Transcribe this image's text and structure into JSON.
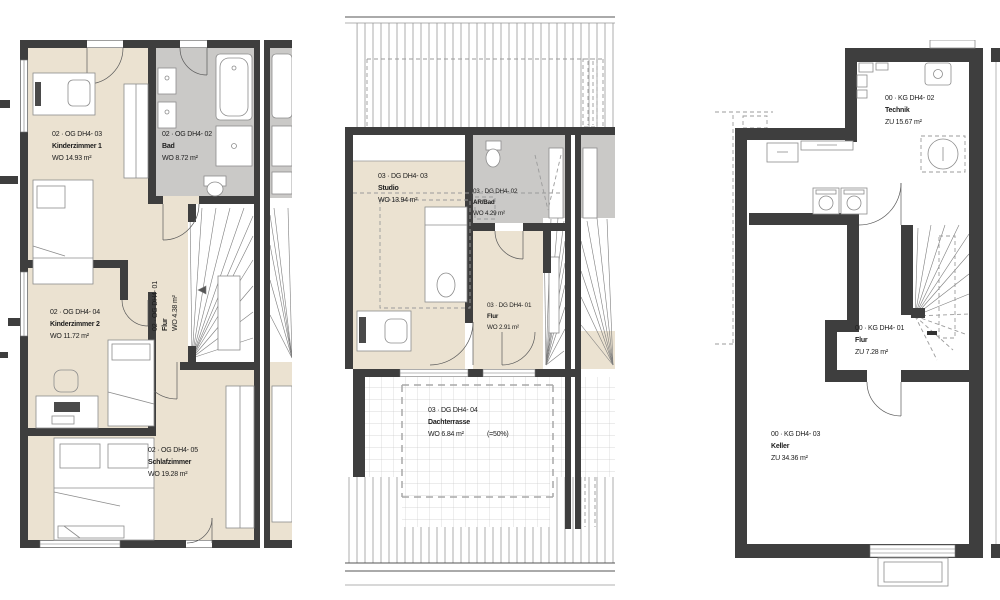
{
  "document": {
    "type": "floor-plan-sheet",
    "units": "m²"
  },
  "colors": {
    "wall": "#3e3e3e",
    "room_beige": "#ebe2d1",
    "bath_gray": "#cac9c7",
    "furniture_line": "#8c8c8c",
    "dashed_gray": "#9b9b9b"
  },
  "plans": {
    "og": {
      "level": "02 OG",
      "rooms": {
        "kinderzimmer1": {
          "code": "02 · OG DH4- 03",
          "name": "Kinderzimmer 1",
          "area": "WO 14.93 m²"
        },
        "bad": {
          "code": "02 · OG DH4- 02",
          "name": "Bad",
          "area": "WO 8.72 m²"
        },
        "flur": {
          "code": "02 · OG DH4- 01",
          "name": "Flur",
          "area": "WO 4.38 m²"
        },
        "kinderzimmer2": {
          "code": "02 · OG DH4- 04",
          "name": "Kinderzimmer 2",
          "area": "WO 11.72 m²"
        },
        "schlafzimmer": {
          "code": "02 · OG DH4- 05",
          "name": "Schlafzimmer",
          "area": "WO 19.28 m²"
        }
      }
    },
    "dg": {
      "level": "03 DG",
      "rooms": {
        "studio": {
          "code": "03 · DG DH4- 03",
          "name": "Studio",
          "area": "WO 13.94 m²"
        },
        "arbad": {
          "code": "03 · DG DH4- 02",
          "name": "AR/Bad",
          "area": "WO 4.29 m²"
        },
        "flur": {
          "code": "03 · DG DH4- 01",
          "name": "Flur",
          "area": "WO 2.91 m²"
        },
        "dachterrasse": {
          "code": "03 · DG DH4- 04",
          "name": "Dachterrasse",
          "area": "WO 6.84 m²",
          "area_note": "(=50%)"
        }
      }
    },
    "kg": {
      "level": "00 KG",
      "rooms": {
        "technik": {
          "code": "00 · KG DH4- 02",
          "name": "Technik",
          "area": "ZU  15.67 m²"
        },
        "flur": {
          "code": "00 · KG DH4- 01",
          "name": "Flur",
          "area": "ZU  7.28 m²"
        },
        "keller": {
          "code": "00 · KG DH4- 03",
          "name": "Keller",
          "area": "ZU  34.36 m²"
        }
      }
    }
  }
}
